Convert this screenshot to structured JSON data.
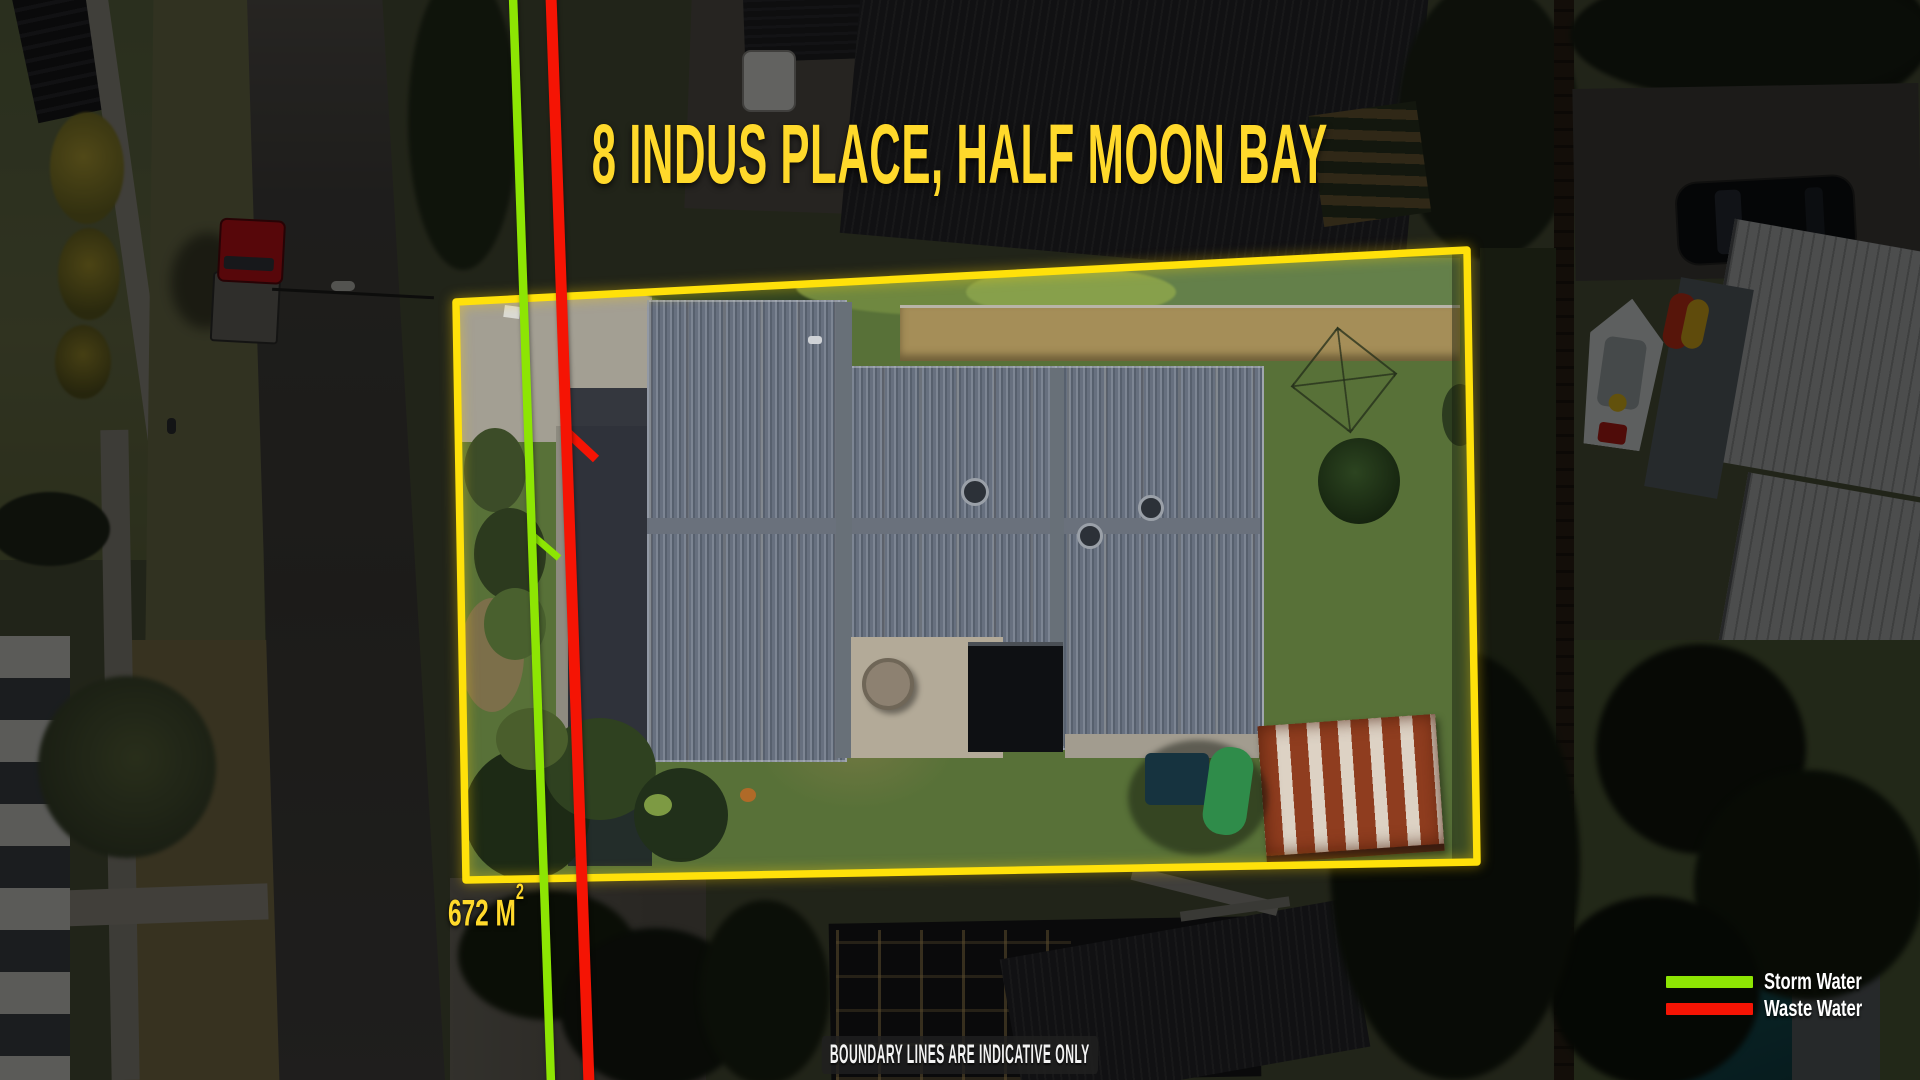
{
  "title": {
    "text": "8 INDUS PLACE, HALF MOON BAY",
    "color": "#FFD92B"
  },
  "area_label": {
    "value": "672 M",
    "superscript": "2",
    "color": "#FFD92B"
  },
  "legend": {
    "items": [
      {
        "label": "Storm Water",
        "color": "#8DE503"
      },
      {
        "label": "Waste Water",
        "color": "#F51404"
      }
    ]
  },
  "annotations": {
    "boundary_color": "#FFE10A",
    "storm_water_line": "vertical green utility line with branch stub",
    "waste_water_line": "vertical red utility line with branch stub"
  },
  "disclaimer": {
    "text": "BOUNDARY LINES ARE INDICATIVE ONLY"
  }
}
